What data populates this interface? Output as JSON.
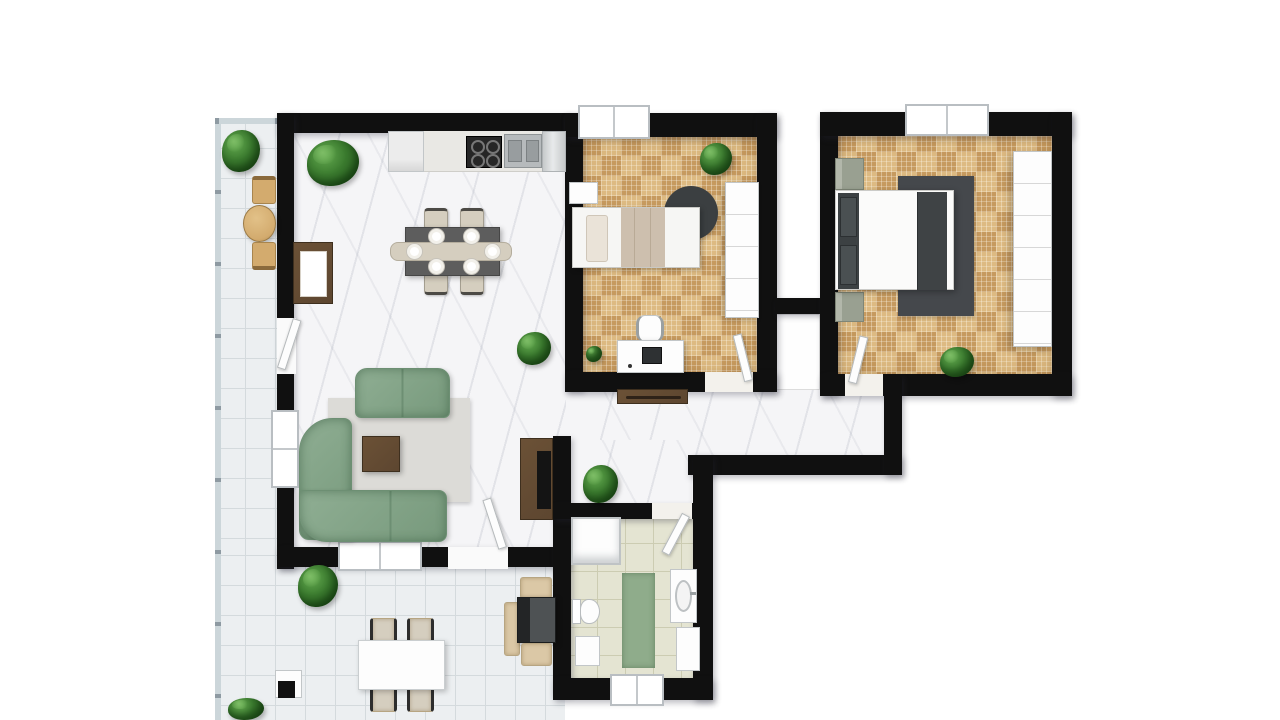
{
  "scene": {
    "type": "apartment-floor-plan",
    "view": "top-down-3d-render",
    "background": "#ffffff",
    "visible_text": "none"
  },
  "palette": {
    "wall": "#101010",
    "marble": "#f5f5f7",
    "parquetLight": "#ddba82",
    "parquetDark": "#c69a5f",
    "terraceTile": "#eceff1",
    "terraceLine": "#d4dadd",
    "bathTile": "#e4e4d2",
    "bathLine": "#ccccb2",
    "sofaGreen": "#8fae93",
    "sofaGreenDark": "#77997c",
    "rugGray": "#dcdbd7",
    "rugDark": "#45484c",
    "woodBrown": "#5d4630",
    "woodLight": "#d3ab6e",
    "white": "#fdfdfd",
    "steel": "#b6babc",
    "cooktop": "#262626",
    "cream": "#d5cebf",
    "beige": "#dbc8a6",
    "blanketBeige": "#cdbfae",
    "blanketDark": "#3f4345",
    "nightstand": "#99a091",
    "plantGreen": "#3a7a2e",
    "plantDark": "#265c1d",
    "bathRug": "#8fac8b",
    "glass": "#ccd6da"
  },
  "rooms": {
    "living_dining_kitchen": {
      "floor": "white-marble",
      "items": [
        "kitchen-counter-row",
        "fridge",
        "cooktop-4-burners",
        "double-sink",
        "dining-table",
        "6 dining-chairs",
        "6 plates",
        "sideboard",
        "green-sofa-2seat",
        "green-corner-sofa",
        "gray-rug",
        "coffee-table",
        "tv-stand-with-tv",
        "2 plants"
      ]
    },
    "bedroom_small": {
      "floor": "oak-parquet",
      "items": [
        "single-bed",
        "head-shelf",
        "round-dark-rug",
        "wardrobe",
        "desk",
        "monitor",
        "desk-chair",
        "2 plants"
      ]
    },
    "bedroom_master": {
      "floor": "oak-parquet",
      "items": [
        "double-bed",
        "2 nightstands",
        "dark-rug",
        "tall-wardrobe",
        "plant"
      ]
    },
    "bathroom": {
      "floor": "beige-tile",
      "items": [
        "shower",
        "toilet",
        "small-cabinet",
        "green-rug",
        "vanity-sink",
        "vanity-cabinet",
        "window"
      ]
    },
    "hallway": {
      "floor": "white-marble",
      "items": [
        "console-shelf",
        "plant",
        "closet-niche"
      ]
    },
    "terrace": {
      "floor": "white-tile",
      "items": [
        "glass-railing",
        "bistro-round-table",
        "2 wood-chairs",
        "outdoor-dining-table",
        "4 outdoor-chairs",
        "grill",
        "3 seat-cushions",
        "side-stool",
        "4 plants"
      ]
    },
    "windows": 5,
    "interior_doors": 5
  }
}
